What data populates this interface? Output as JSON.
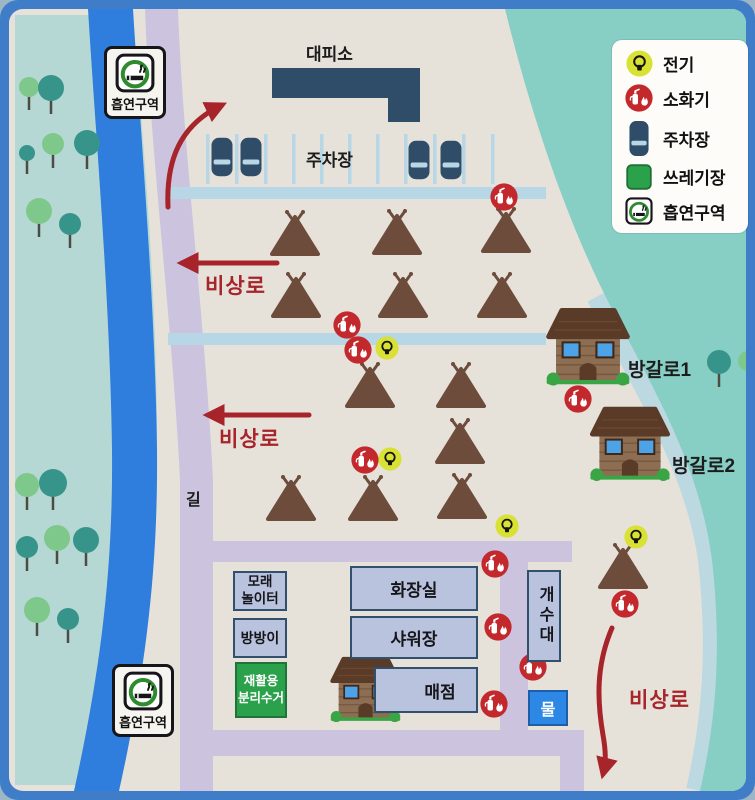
{
  "labels": {
    "shelter": "대피소",
    "parking_lot": "주차장",
    "emergency_route": "비상로",
    "road": "길",
    "bungalow_1": "방갈로1",
    "bungalow_2": "방갈로2",
    "smoking_area": "흡연구역"
  },
  "legend": {
    "items": [
      {
        "icon": "electricity-icon",
        "label": "전기"
      },
      {
        "icon": "fire-extinguisher-icon",
        "label": "소화기"
      },
      {
        "icon": "parking-icon",
        "label": "주차장"
      },
      {
        "icon": "trash-area-icon",
        "label": "쓰레기장"
      },
      {
        "icon": "smoking-area-icon",
        "label": "흡연구역"
      }
    ]
  },
  "facilities": {
    "sand_playground": {
      "label": "모래\n놀이터"
    },
    "trampoline": {
      "label": "방방이"
    },
    "recycling": {
      "label": "재활용\n분리수거"
    },
    "toilet": {
      "label": "화장실"
    },
    "shower": {
      "label": "샤워장"
    },
    "store": {
      "label": "매점"
    },
    "sink": {
      "label": "개수대"
    },
    "water": {
      "label": "물"
    }
  },
  "map_items": {
    "tents": [
      [
        295,
        209
      ],
      [
        397,
        208
      ],
      [
        506,
        206
      ],
      [
        296,
        271
      ],
      [
        403,
        271
      ],
      [
        502,
        271
      ],
      [
        370,
        361
      ],
      [
        461,
        361
      ],
      [
        460,
        417
      ],
      [
        291,
        474
      ],
      [
        373,
        474
      ],
      [
        462,
        472
      ],
      [
        623,
        542
      ]
    ],
    "fire_extinguishers": [
      [
        504,
        197
      ],
      [
        347,
        325
      ],
      [
        358,
        350
      ],
      [
        578,
        399
      ],
      [
        365,
        460
      ],
      [
        495,
        564
      ],
      [
        498,
        627
      ],
      [
        533,
        667
      ],
      [
        494,
        704
      ],
      [
        625,
        604
      ]
    ],
    "electricity": [
      [
        387,
        348
      ],
      [
        390,
        459
      ],
      [
        507,
        526
      ],
      [
        636,
        537
      ]
    ],
    "cars": [
      [
        222,
        157
      ],
      [
        251,
        157
      ],
      [
        419,
        160
      ],
      [
        451,
        160
      ]
    ],
    "trees": [
      {
        "x": 29,
        "y": 87,
        "r": 10,
        "c": "g"
      },
      {
        "x": 51,
        "y": 88,
        "r": 13,
        "c": "t"
      },
      {
        "x": 53,
        "y": 144,
        "r": 11,
        "c": "g"
      },
      {
        "x": 27,
        "y": 153,
        "r": 8,
        "c": "t"
      },
      {
        "x": 87,
        "y": 143,
        "r": 13,
        "c": "t"
      },
      {
        "x": 39,
        "y": 211,
        "r": 13,
        "c": "g"
      },
      {
        "x": 70,
        "y": 224,
        "r": 11,
        "c": "t"
      },
      {
        "x": 27,
        "y": 485,
        "r": 12,
        "c": "g"
      },
      {
        "x": 53,
        "y": 483,
        "r": 14,
        "c": "t"
      },
      {
        "x": 57,
        "y": 538,
        "r": 13,
        "c": "g"
      },
      {
        "x": 86,
        "y": 540,
        "r": 13,
        "c": "t"
      },
      {
        "x": 27,
        "y": 547,
        "r": 11,
        "c": "t"
      },
      {
        "x": 37,
        "y": 610,
        "r": 13,
        "c": "g"
      },
      {
        "x": 68,
        "y": 619,
        "r": 11,
        "c": "t"
      },
      {
        "x": 719,
        "y": 362,
        "r": 12,
        "c": "t"
      },
      {
        "x": 748,
        "y": 361,
        "r": 10,
        "c": "g"
      }
    ]
  },
  "colors": {
    "frame_blue": "#3f7dc8",
    "map_bg": "#e6e2da",
    "pale_teal": "#b5d8d4",
    "teal_area": "#87cec5",
    "river_blue": "#2f7ddc",
    "road_lavender": "#ccc4de",
    "road_lightblue": "#b7d6e6",
    "accent_red": "#a6242a",
    "fire_red": "#c3282d",
    "electric_yellow": "#d9e135",
    "navy": "#2f4d68",
    "tent_brown": "#6d4c3b",
    "teal_tree": "#37948b",
    "green_tree": "#7fc88b"
  }
}
